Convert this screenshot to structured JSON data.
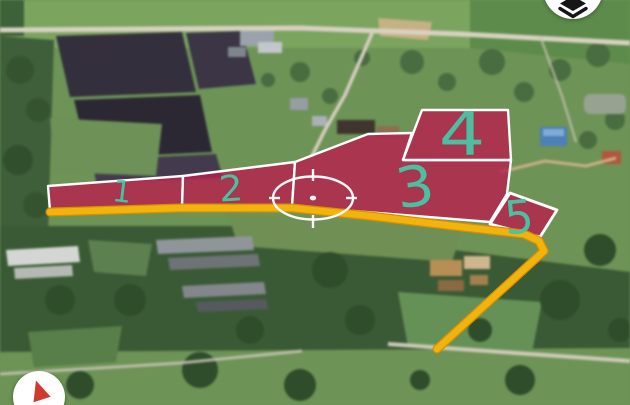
{
  "view": {
    "type": "satellite-map",
    "colors": {
      "parcel_fill": "#b81e4e",
      "parcel_border": "#ffffff",
      "parcel_label": "#4cc3a4",
      "route": "#f2b40c",
      "crosshair": "#ffffff"
    },
    "parcels": [
      {
        "label": "1"
      },
      {
        "label": "2"
      },
      {
        "label": "3"
      },
      {
        "label": "4"
      },
      {
        "label": "5"
      }
    ]
  },
  "controls": {
    "layers_button": {
      "icon": "layers-icon"
    },
    "compass_button": {
      "icon": "compass-north-icon"
    }
  }
}
